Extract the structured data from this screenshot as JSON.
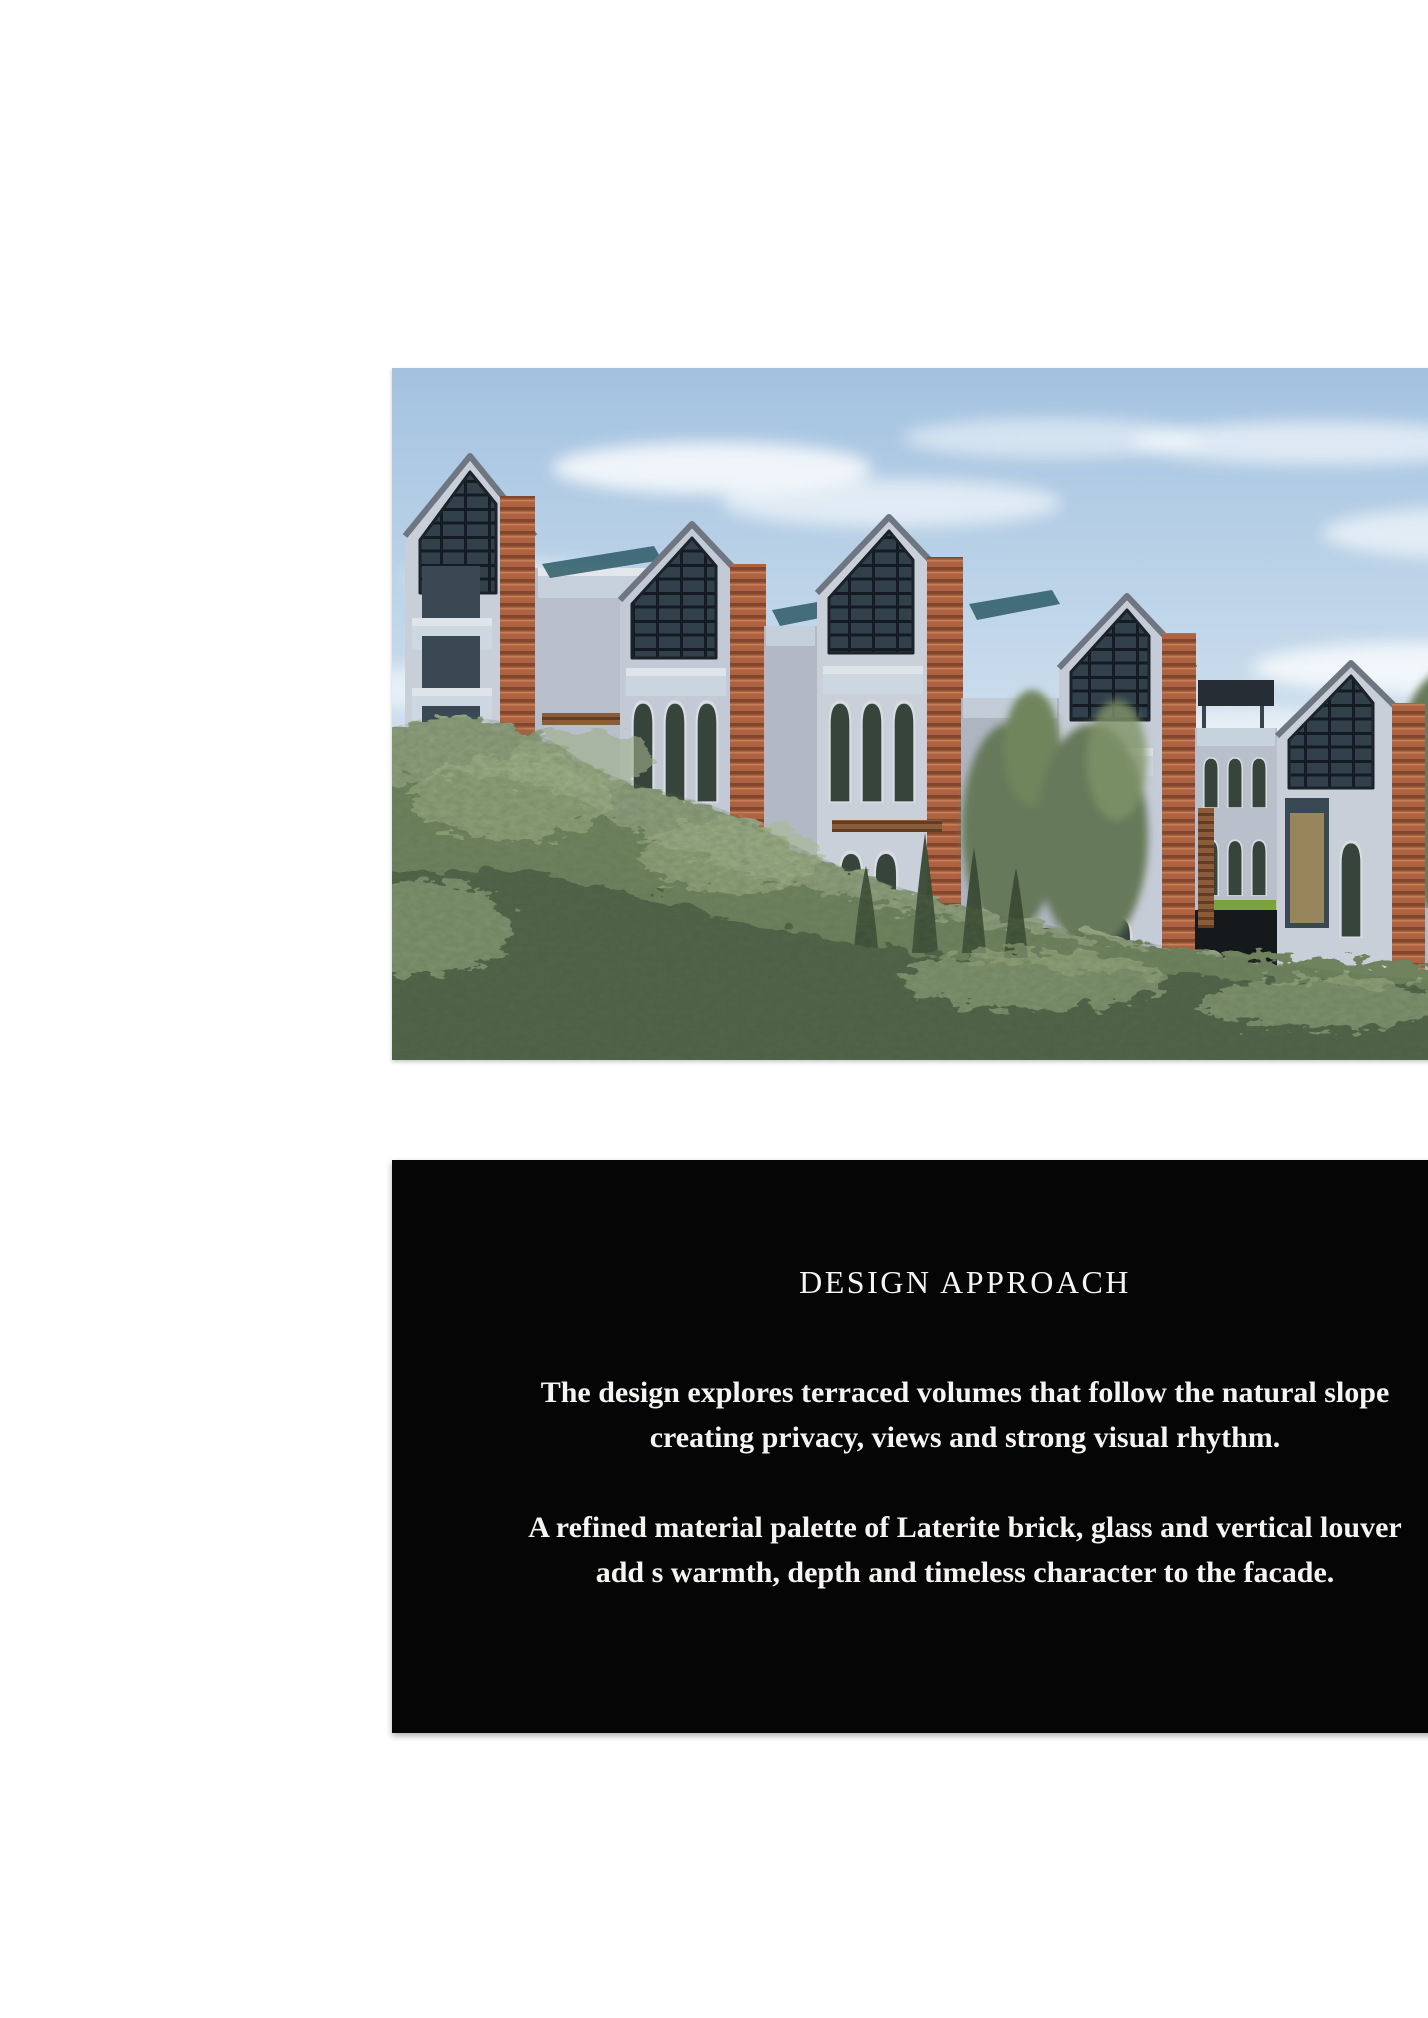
{
  "page": {
    "background_color": "#ffffff"
  },
  "hero_image": {
    "semantic_name": "terraced-townhouses-architectural-rendering",
    "palette": {
      "sky": "#aecbe4",
      "wall_gray": "#c9cfd9",
      "laterite_brick": "#a85c3e",
      "foliage_green": "#70835f"
    }
  },
  "design_panel": {
    "background_color": "#050505",
    "text_color": "#f5f4f2",
    "title": "DESIGN APPROACH",
    "paragraph1": {
      "line1": "The design explores terraced volumes that follow the natural slope",
      "line2": "creating privacy, views and strong visual rhythm."
    },
    "paragraph2": {
      "line1": "A refined material palette of Laterite brick, glass and vertical louver",
      "line2": "add s warmth, depth and timeless character to the facade."
    }
  }
}
